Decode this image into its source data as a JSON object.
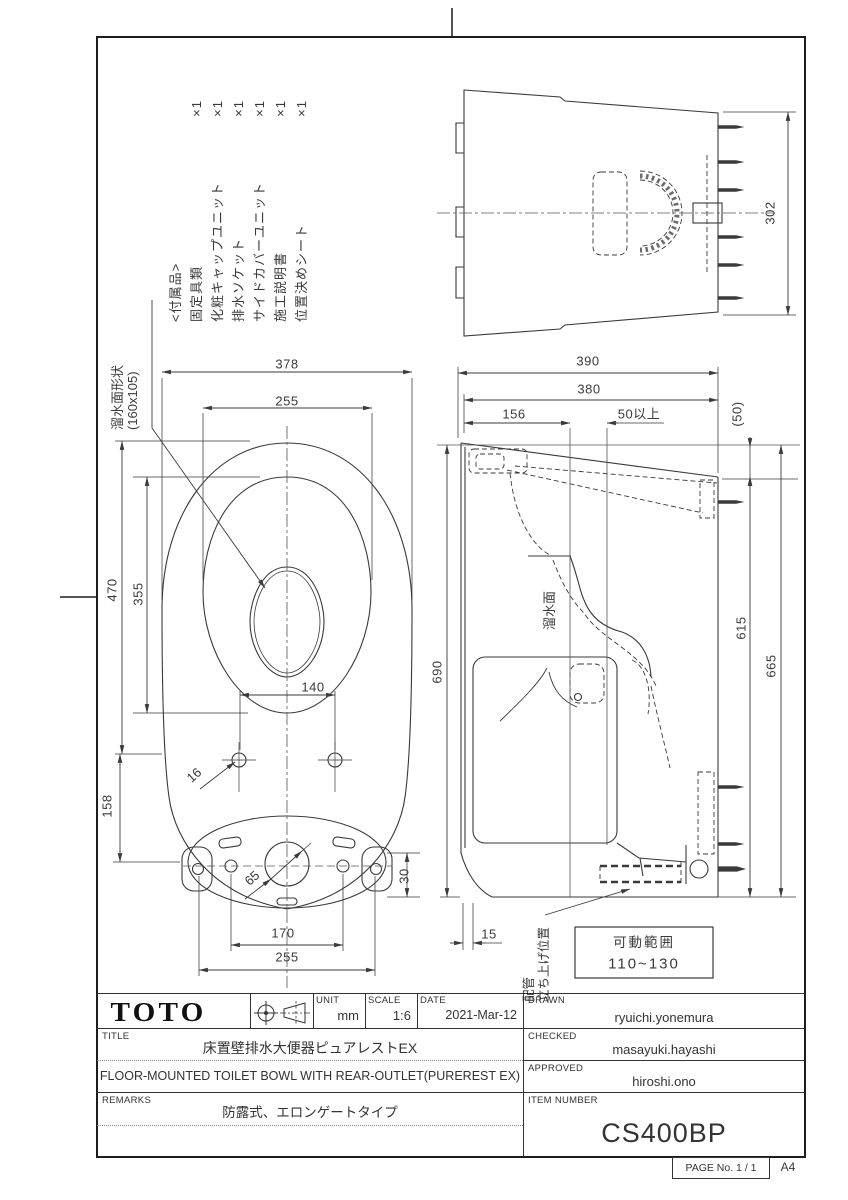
{
  "sheet": {
    "paper_size": "A4",
    "page_no": "PAGE No.  1 / 1"
  },
  "accessories": {
    "heading": "<付属品>",
    "items": [
      {
        "label": "固定具類",
        "qty": "×1"
      },
      {
        "label": "化粧キャップユニット",
        "qty": "×1"
      },
      {
        "label": "排水ソケット",
        "qty": "×1"
      },
      {
        "label": "サイドカバーユニット",
        "qty": "×1"
      },
      {
        "label": "施工説明書",
        "qty": "×1"
      },
      {
        "label": "位置決めシート",
        "qty": "×1"
      }
    ]
  },
  "plan_view": {
    "water_surface_label": "溜水面形状",
    "water_surface_size": "(160x105)",
    "dims": {
      "overall_width": "378",
      "rim_width": "255",
      "overall_length": "470",
      "rim_length": "355",
      "water_width": "140",
      "bolt_hole_dia": "16",
      "hole_offset": "158",
      "center_dia": "65",
      "base_offset": "30",
      "inner_hole_pitch": "170",
      "outer_hole_pitch": "255"
    }
  },
  "side_view": {
    "water_surface_label": "溜水面",
    "pipe_label_1": "配管",
    "pipe_label_2": "立ち上げ位置",
    "range_title": "可動範囲",
    "range_value": "110~130",
    "dims": {
      "depth_total": "390",
      "depth_body": "380",
      "drain_center": "156",
      "clearance": "50以上",
      "rear_drop": "(50)",
      "height_front": "690",
      "height_rear": "615",
      "height_total": "665",
      "base_inset": "15"
    }
  },
  "rear_view": {
    "dims": {
      "width": "302"
    }
  },
  "title_block": {
    "logo": "TOTO",
    "unit_label": "UNIT",
    "unit_value": "mm",
    "scale_label": "SCALE",
    "scale_value": "1:6",
    "date_label": "DATE",
    "date_value": "2021-Mar-12",
    "title_label": "TITLE",
    "title_jp": "床置壁排水大便器ピュアレストEX",
    "title_en": "FLOOR-MOUNTED TOILET BOWL WITH REAR-OUTLET(PUREREST EX)",
    "remarks_label": "REMARKS",
    "remarks_value": "防露式、エロンゲートタイプ",
    "drawn_label": "DRAWN",
    "drawn_value": "ryuichi.yonemura",
    "checked_label": "CHECKED",
    "checked_value": "masayuki.hayashi",
    "approved_label": "APPROVED",
    "approved_value": "hiroshi.ono",
    "item_label": "ITEM NUMBER",
    "item_value": "CS400BP"
  }
}
